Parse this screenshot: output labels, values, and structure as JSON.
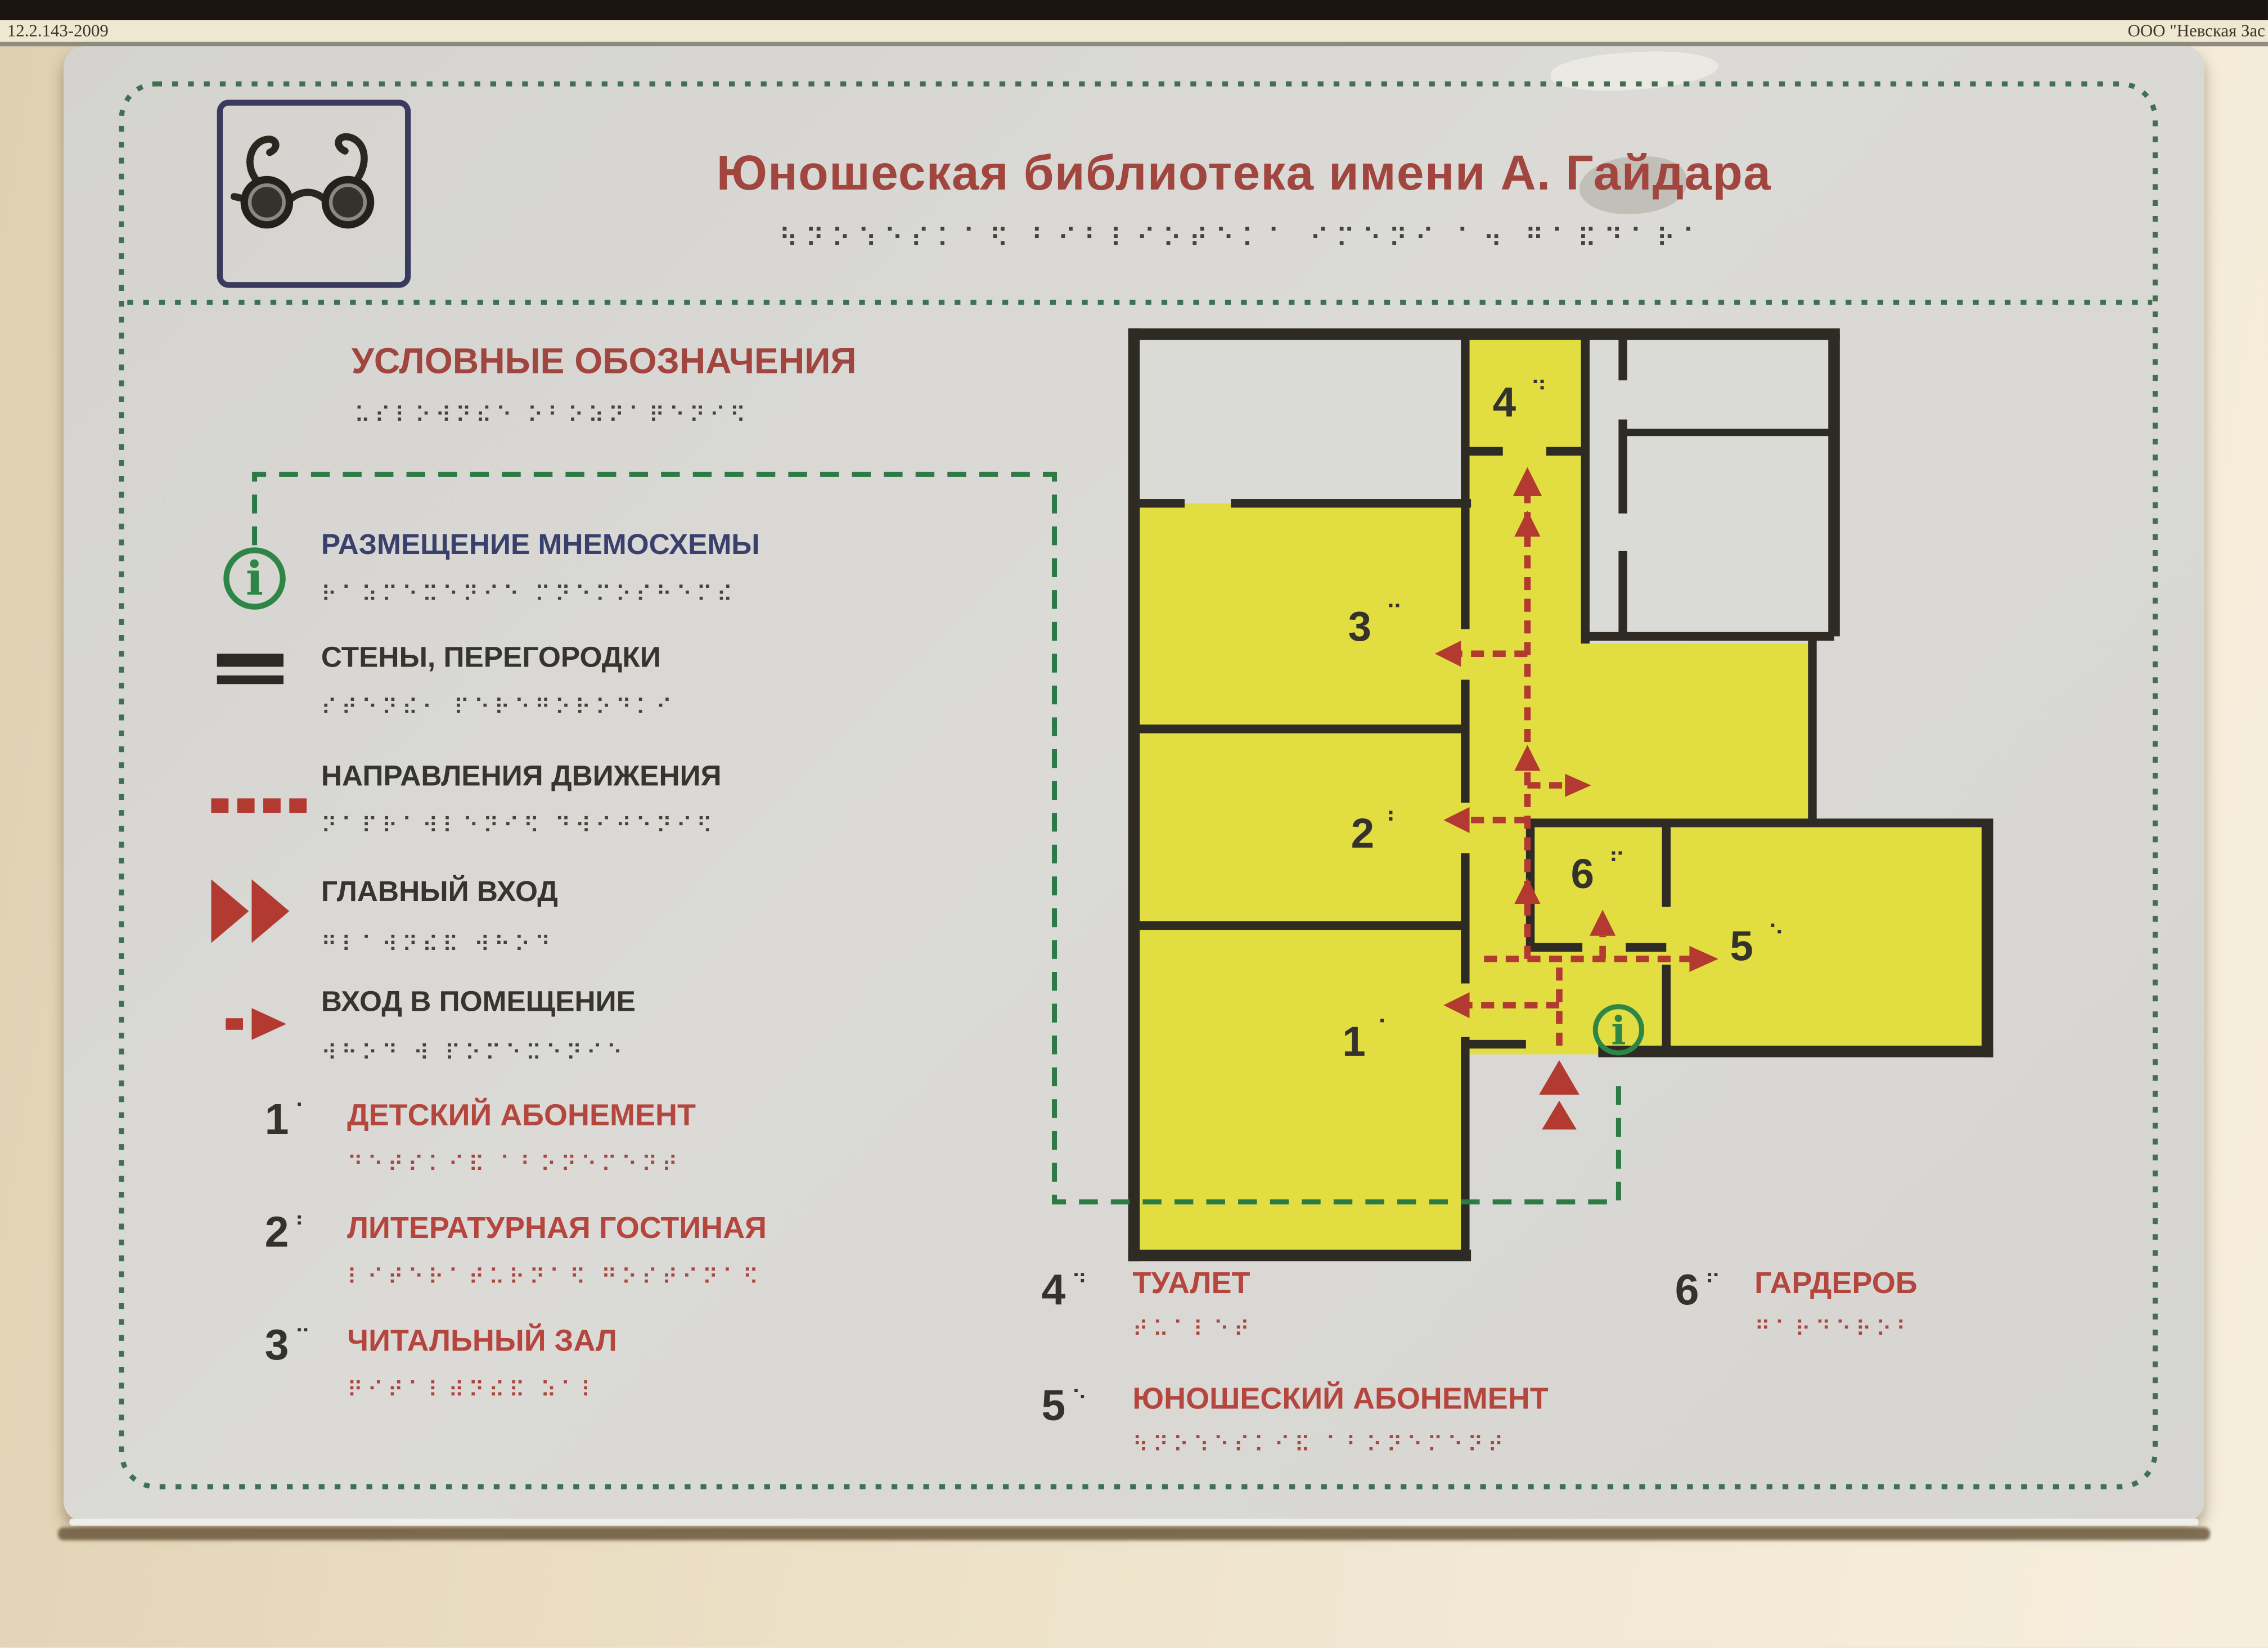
{
  "frame": {
    "top_left_code": "12.2.143-2009",
    "top_right_label": "ООО \"Невская Зас"
  },
  "sign": {
    "title": "Юношеская библиотека имени А. Гайдара",
    "title_braille": "⠳⠝⠕⠱⠑⠎⠅⠁⠫ ⠃⠊⠃⠇⠊⠕⠞⠑⠅⠁ ⠊⠍⠑⠝⠊ ⠁⠲ ⠛⠁⠯⠙⠁⠗⠁",
    "icons": {
      "glasses": "glasses-icon",
      "info_legend": "i",
      "info_map": "i"
    },
    "legend": {
      "heading": "УСЛОВНЫЕ ОБОЗНАЧЕНИЯ",
      "heading_braille": "⠥⠎⠇⠕⠺⠝⠮⠑ ⠕⠃⠕⠵⠝⠁⠟⠑⠝⠊⠫",
      "items": [
        {
          "label": "РАЗМЕЩЕНИЕ МНЕМОСХЕМЫ",
          "braille": "⠗⠁⠵⠍⠑⠭⠑⠝⠊⠑ ⠍⠝⠑⠍⠕⠎⠓⠑⠍⠮",
          "symbol": "info-icon"
        },
        {
          "label": "СТЕНЫ, ПЕРЕГОРОДКИ",
          "braille": "⠎⠞⠑⠝⠮⠂ ⠏⠑⠗⠑⠛⠕⠗⠕⠙⠅⠊",
          "symbol": "double-bar"
        },
        {
          "label": "НАПРАВЛЕНИЯ ДВИЖЕНИЯ",
          "braille": "⠝⠁⠏⠗⠁⠺⠇⠑⠝⠊⠫ ⠙⠺⠊⠚⠑⠝⠊⠫",
          "symbol": "red-dashes"
        },
        {
          "label": "ГЛАВНЫЙ ВХОД",
          "braille": "⠛⠇⠁⠺⠝⠮⠯ ⠺⠓⠕⠙",
          "symbol": "double-triangle"
        },
        {
          "label": "ВХОД В ПОМЕЩЕНИЕ",
          "braille": "⠺⠓⠕⠙ ⠺ ⠏⠕⠍⠑⠭⠑⠝⠊⠑",
          "symbol": "dash-arrow"
        }
      ]
    },
    "rooms": [
      {
        "num": "1",
        "dots": "⠁",
        "label": "ДЕТСКИЙ АБОНЕМЕНТ",
        "braille": "⠙⠑⠞⠎⠅⠊⠯ ⠁⠃⠕⠝⠑⠍⠑⠝⠞"
      },
      {
        "num": "2",
        "dots": "⠃",
        "label": "ЛИТЕРАТУРНАЯ ГОСТИНАЯ",
        "braille": "⠇⠊⠞⠑⠗⠁⠞⠥⠗⠝⠁⠫ ⠛⠕⠎⠞⠊⠝⠁⠫"
      },
      {
        "num": "3",
        "dots": "⠉",
        "label": "ЧИТАЛЬНЫЙ ЗАЛ",
        "braille": "⠟⠊⠞⠁⠇⠾⠝⠮⠯ ⠵⠁⠇"
      },
      {
        "num": "4",
        "dots": "⠙",
        "label": "ТУАЛЕТ",
        "braille": "⠞⠥⠁⠇⠑⠞"
      },
      {
        "num": "5",
        "dots": "⠑",
        "label": "ЮНОШЕСКИЙ АБОНЕМЕНТ",
        "braille": "⠳⠝⠕⠱⠑⠎⠅⠊⠯ ⠁⠃⠕⠝⠑⠍⠑⠝⠞"
      },
      {
        "num": "6",
        "dots": "⠋",
        "label": "ГАРДЕРОБ",
        "braille": "⠛⠁⠗⠙⠑⠗⠕⠃"
      }
    ]
  },
  "colors": {
    "panel": "#d8d7d3",
    "wall_beige": "#e9dcc0",
    "room_yellow": "#e2de42",
    "plan_walls": "#2e2b25",
    "accent_red": "#b23a31",
    "text_maroon": "#a1453f",
    "text_navy": "#39406b",
    "green_route": "#2d7a44",
    "border_green": "#3f7050"
  }
}
